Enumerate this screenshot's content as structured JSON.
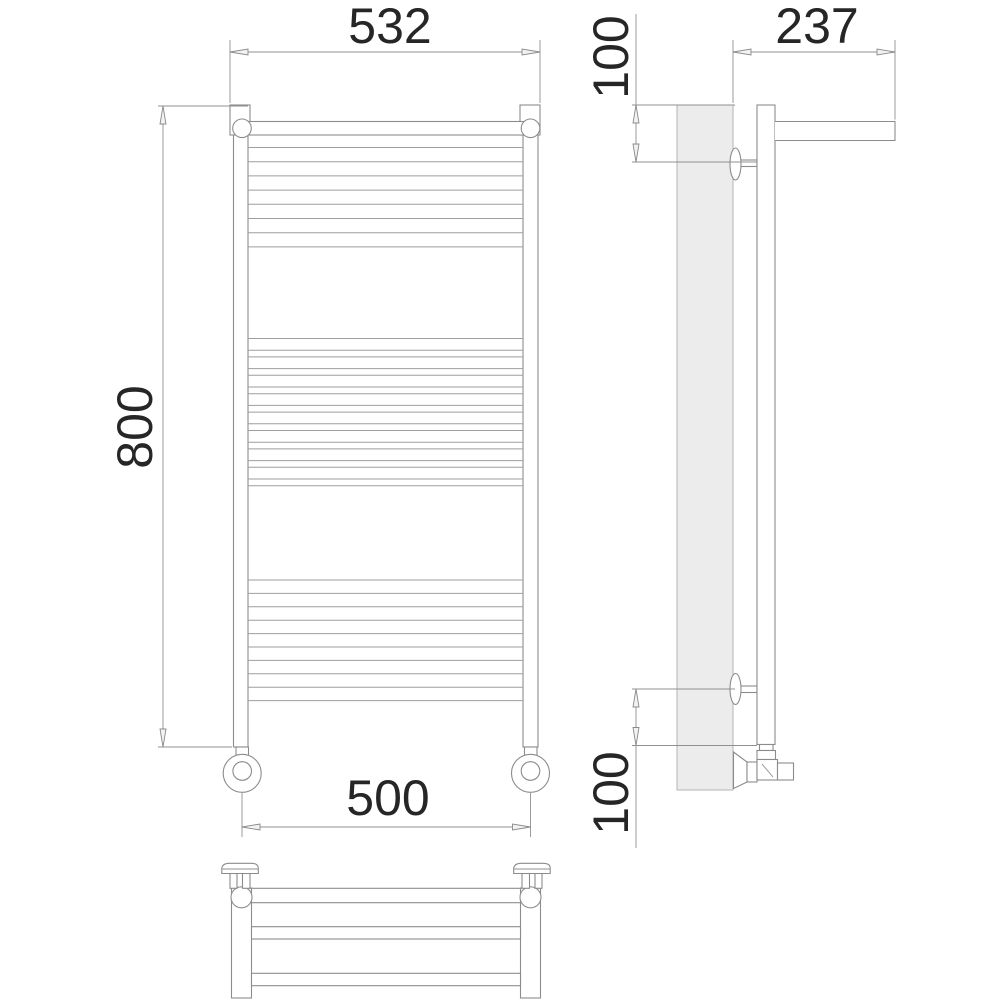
{
  "drawing": {
    "dimensions": {
      "width_top": "532",
      "height": "800",
      "width_bottom": "500",
      "depth": "237",
      "offset_top": "100",
      "offset_bottom": "100"
    },
    "colors": {
      "line": "#8c8c8c",
      "rung_line": "#9e9e9e",
      "dimension_line": "#909090",
      "text": "#262626",
      "wall_fill": "#ececec",
      "background": "#ffffff"
    }
  }
}
